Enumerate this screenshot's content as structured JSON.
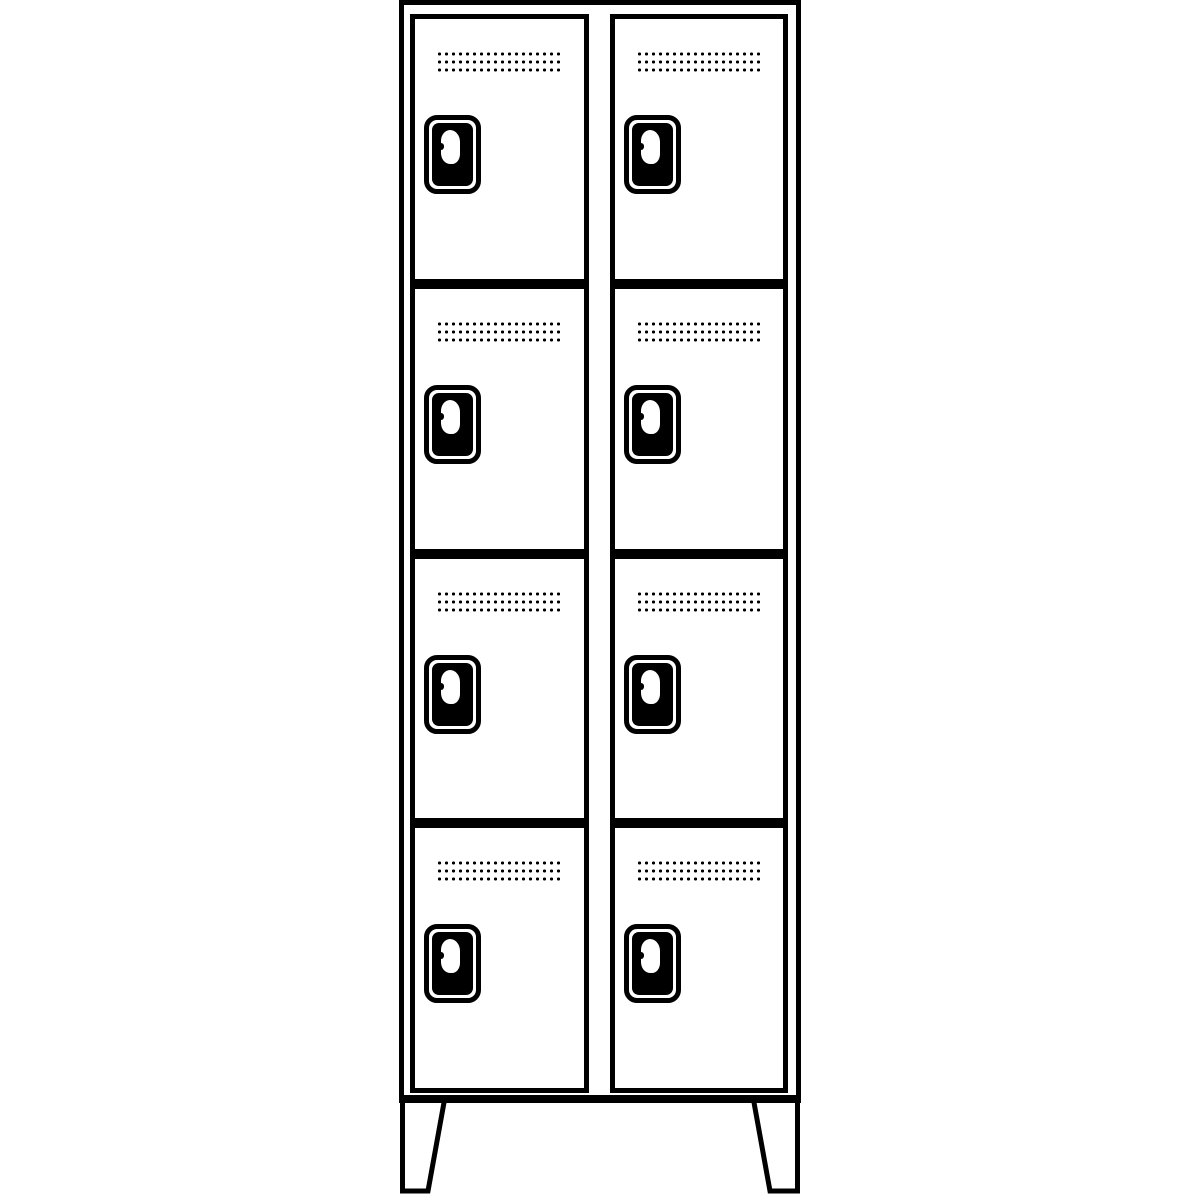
{
  "figure": {
    "description": "Black-and-white technical line drawing of a cloakroom locker unit with two columns of four stacked compartments, each door with a perforated vent grille and a rounded lock plate, standing on two tapered pedestal feet",
    "background_color": "#ffffff",
    "line_color": "#000000",
    "locker": {
      "columns": 2,
      "rows_per_column": 4,
      "total_compartments": 8
    },
    "compartment": {
      "vent_grille": {
        "dot_rows": 3,
        "dot_columns": 18,
        "dot_color": "#000000"
      },
      "lock": {
        "plate_fill": "#000000",
        "plate_outline": "#000000",
        "keyhole_cutout_color": "#ffffff"
      }
    },
    "feet": {
      "count": 2,
      "shape": "tapered trapezoid"
    }
  }
}
